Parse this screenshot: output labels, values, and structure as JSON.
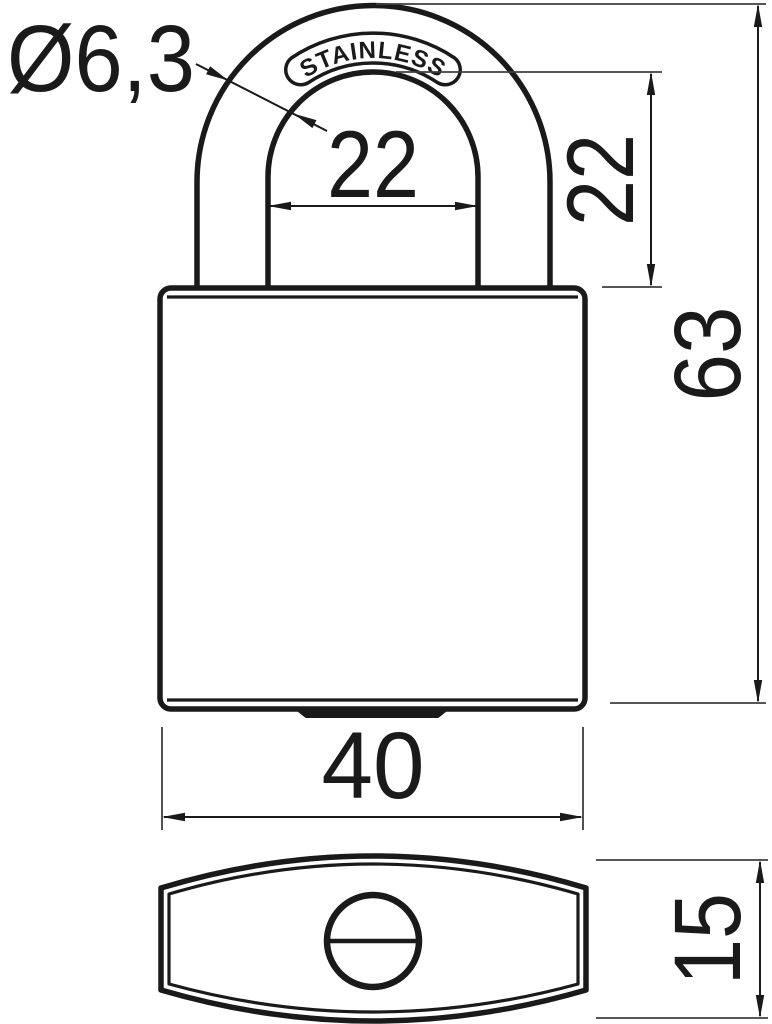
{
  "drawing": {
    "stamp_text": "STAINLESS",
    "dimensions": {
      "shackle_diameter": "Ø6,3",
      "shackle_inner_width": "22",
      "shackle_clearance_height": "22",
      "overall_height": "63",
      "body_width": "40",
      "body_depth": "15"
    },
    "colors": {
      "line": "#1a1a1a",
      "extension_line": "#3f3f3f",
      "background": "#ffffff"
    }
  }
}
